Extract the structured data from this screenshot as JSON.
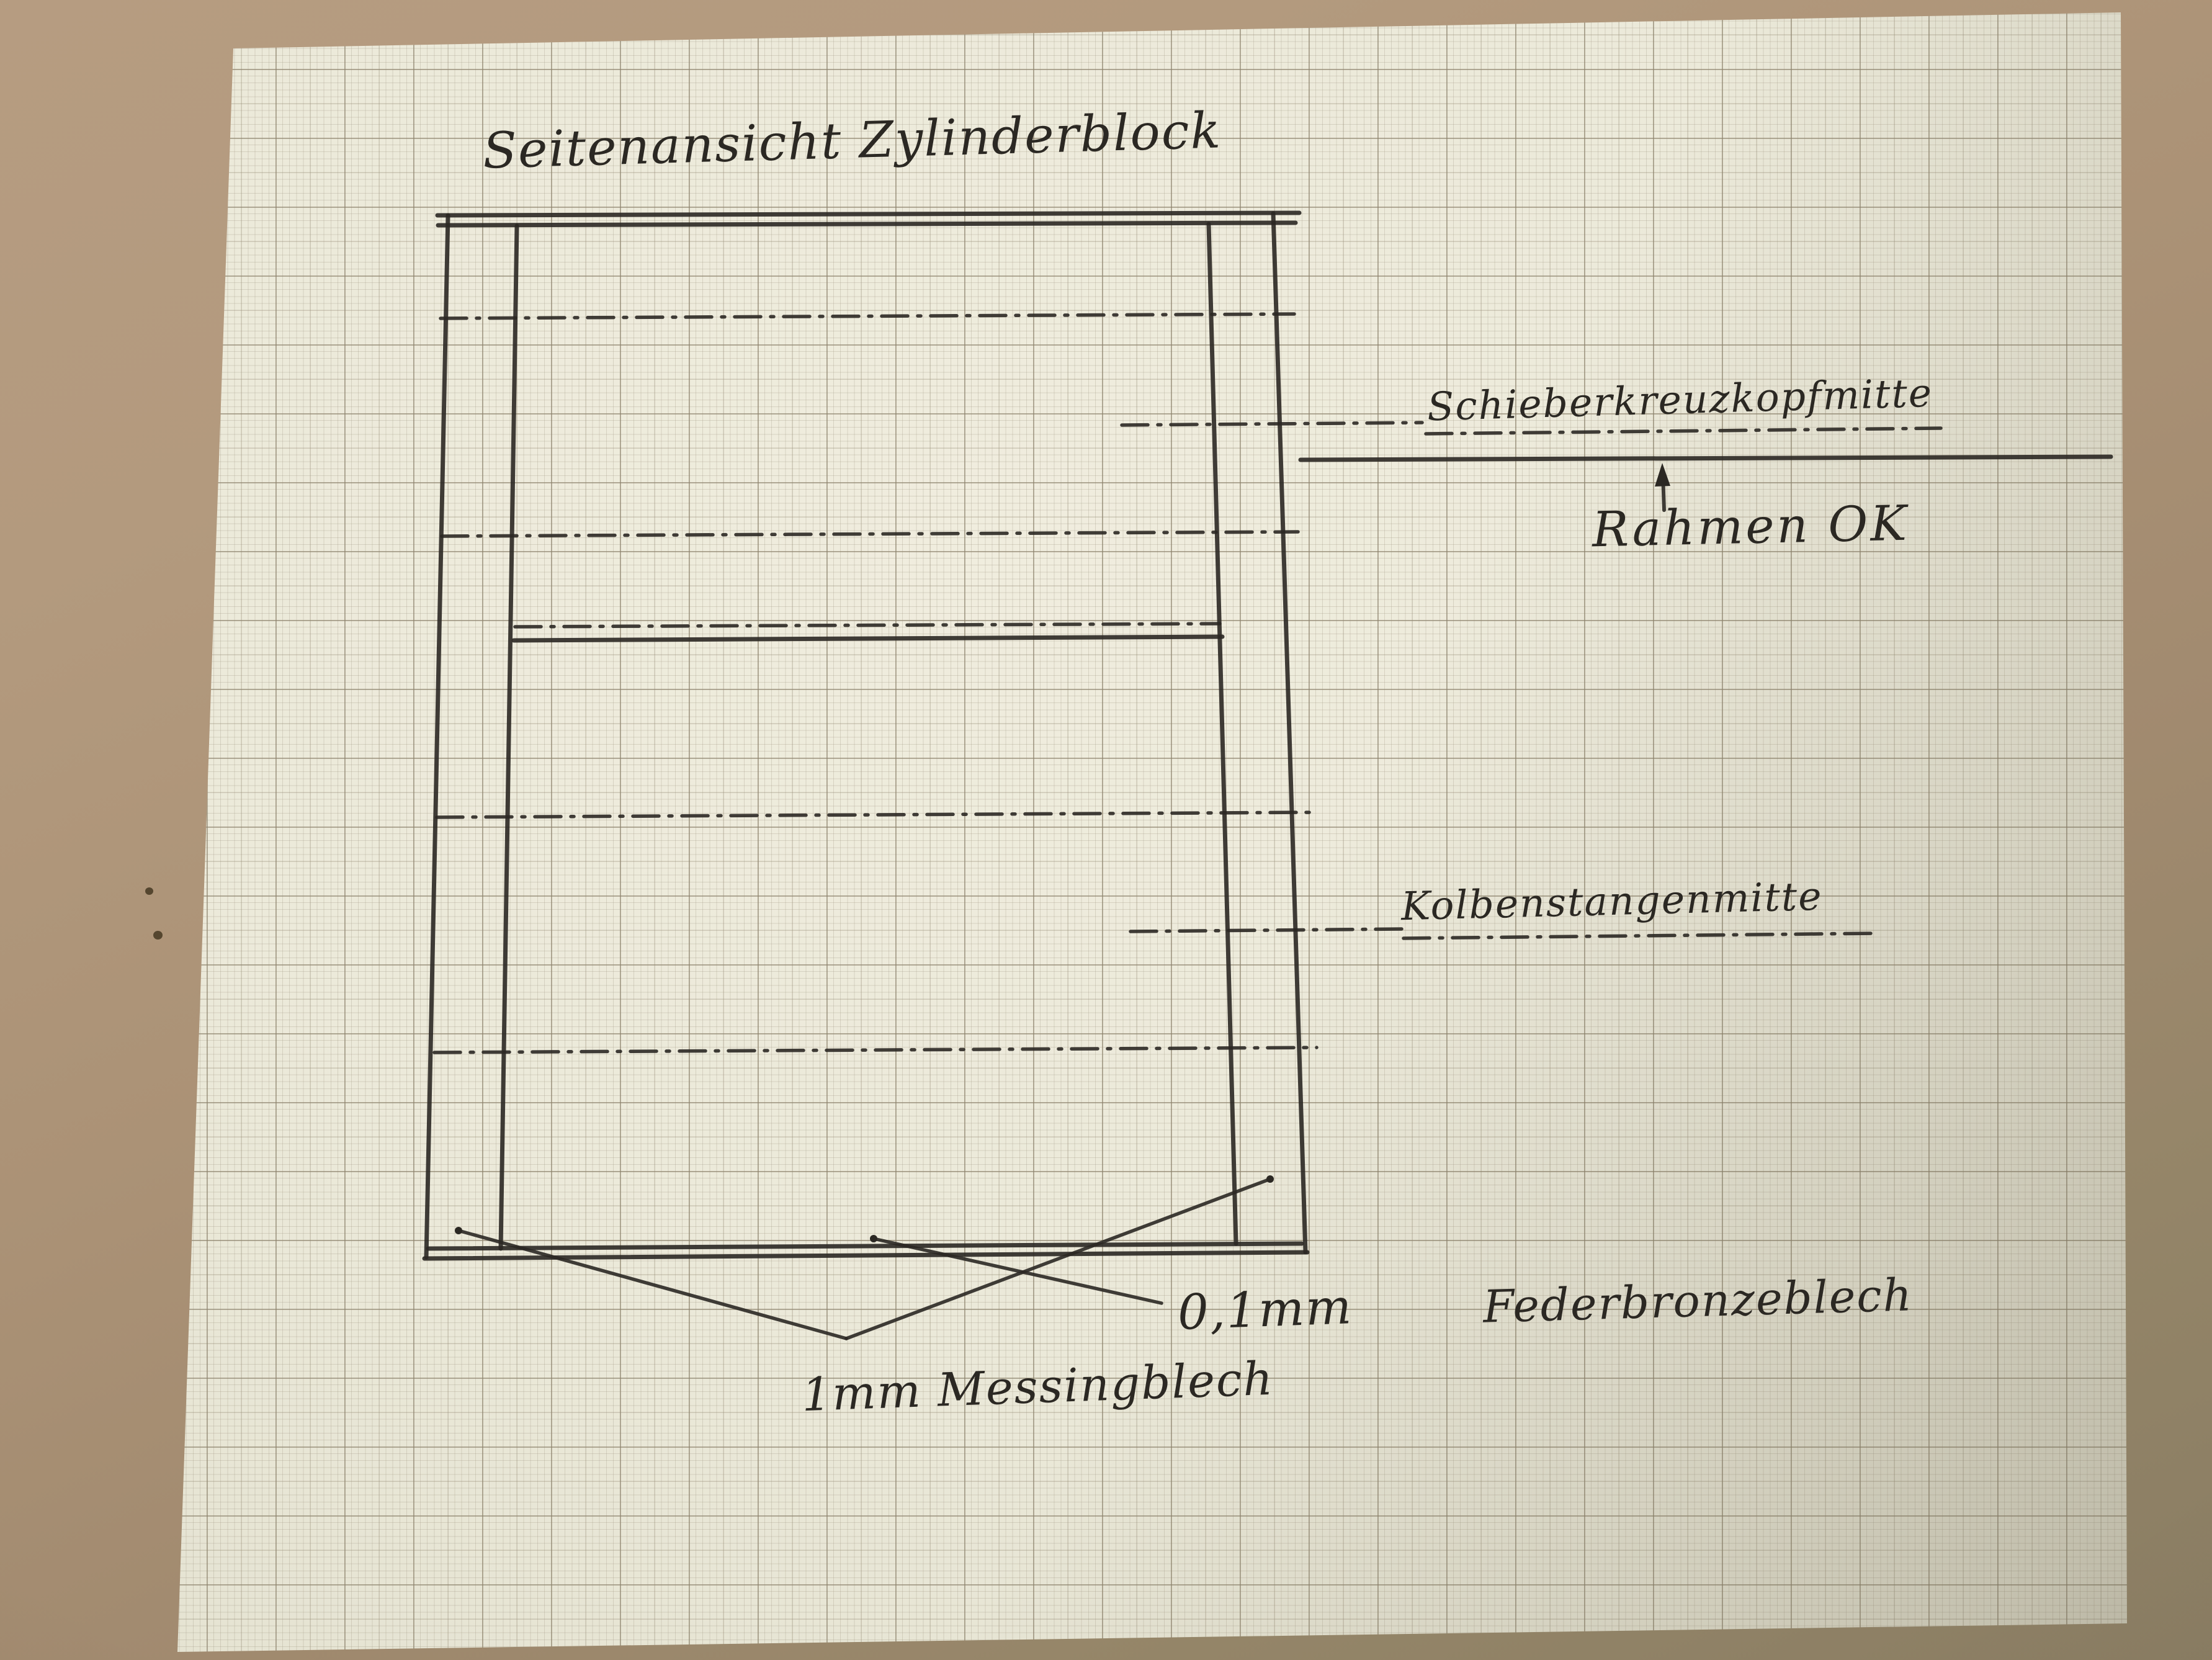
{
  "photo": {
    "background_color": "#ab9276",
    "paper_color": "#ebe9d9",
    "grid_minor_color": "#a89e87",
    "grid_major_color": "#8c826c",
    "ink_color": "#2b2823"
  },
  "title": "Seitenansicht Zylinderblock",
  "annotations": {
    "slide_crosshead_center": "Schieberkreuzkopfmitte",
    "frame_top_edge": "Rahmen OK",
    "piston_rod_center": "Kolbenstangenmitte",
    "bronze_sheet_thickness": "0,1mm",
    "bronze_sheet_material": "Federbronzeblech",
    "brass_sheet_label": "1mm Messingblech"
  }
}
